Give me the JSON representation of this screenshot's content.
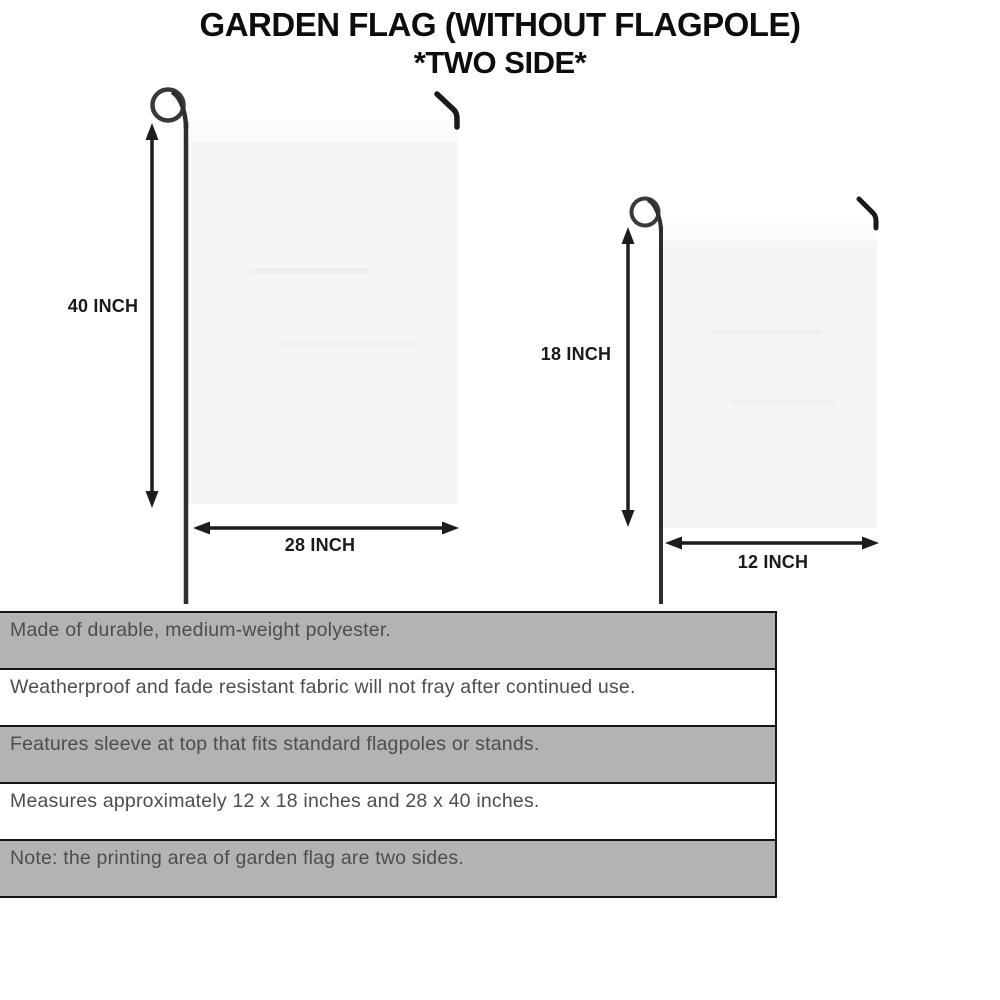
{
  "title": {
    "line1": "GARDEN FLAG (WITHOUT FLAGPOLE)",
    "line2": "*TWO SIDE*"
  },
  "diagram": {
    "large_flag": {
      "height_label": "40 INCH",
      "width_label": "28 INCH"
    },
    "small_flag": {
      "height_label": "18 INCH",
      "width_label": "12 INCH"
    }
  },
  "features": [
    "Made of durable, medium-weight polyester.",
    "Weatherproof and fade resistant fabric will not fray after continued use.",
    "Features sleeve at top that fits standard flagpoles or stands.",
    "Measures approximately 12 x 18 inches and 28 x 40 inches.",
    "Note: the printing area of garden flag are two sides."
  ],
  "colors": {
    "row_gray": "#b3b3b3",
    "row_white": "#ffffff",
    "row_border": "#151515",
    "feature_text": "#4d4d4d",
    "title_text": "#0d0d0d",
    "flag_fill": "#f5f5f6",
    "flag_sleeve": "#fbfbfb",
    "pole": "#2e2e2e",
    "arrow": "#1c1c1c"
  }
}
